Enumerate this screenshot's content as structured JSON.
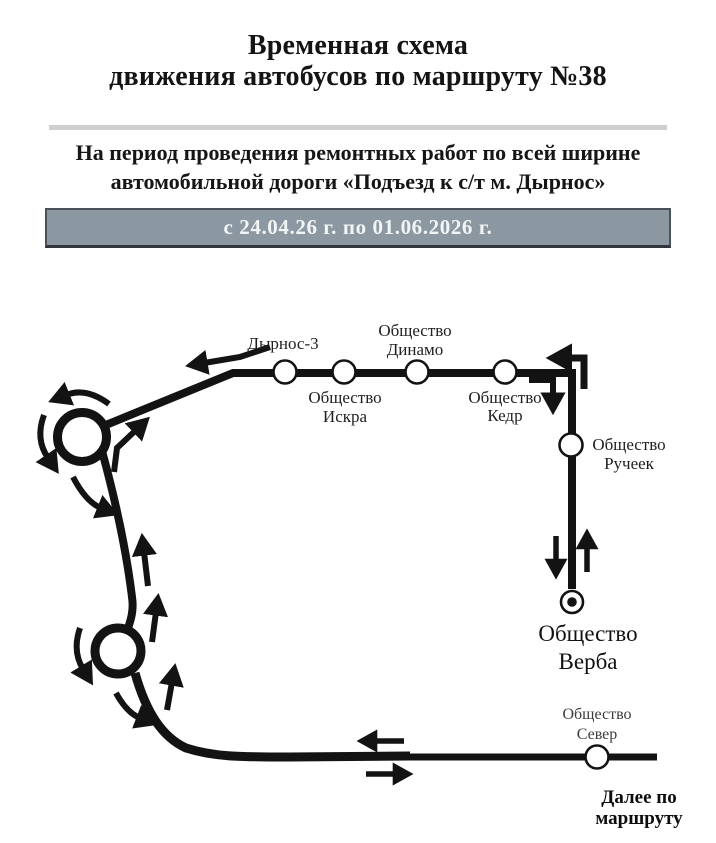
{
  "header": {
    "title_line1": "Временная схема",
    "title_line2": "движения автобусов по маршруту №38",
    "subtitle_line1": "На период проведения ремонтных работ по всей ширине",
    "subtitle_line2": "автомобильной дороги «Подъезд к с/т м. Дырнос»",
    "period": "с  24.04.26 г. по 01.06.2026 г."
  },
  "colors": {
    "banner_background": "#8c98a1",
    "banner_text": "#f2f5f6",
    "banner_border": "#2f353b",
    "divider": "#cfcfcf",
    "route_ink": "#131313"
  },
  "diagram": {
    "stops": {
      "dyrnos3": {
        "name": "Дырнос-3"
      },
      "iskra": {
        "line1": "Общество",
        "line2": "Искра"
      },
      "dinamo": {
        "line1": "Общество",
        "line2": "Динамо"
      },
      "kedr": {
        "line1": "Общество",
        "line2": "Кедр"
      },
      "rucheek": {
        "line1": "Общество",
        "line2": "Ручеек"
      },
      "verba": {
        "line1": "Общество",
        "line2": "Верба"
      },
      "sever": {
        "line1": "Общество",
        "line2": "Север"
      }
    },
    "continuation_note": {
      "line1": "Далее по",
      "line2": "маршруту"
    }
  }
}
